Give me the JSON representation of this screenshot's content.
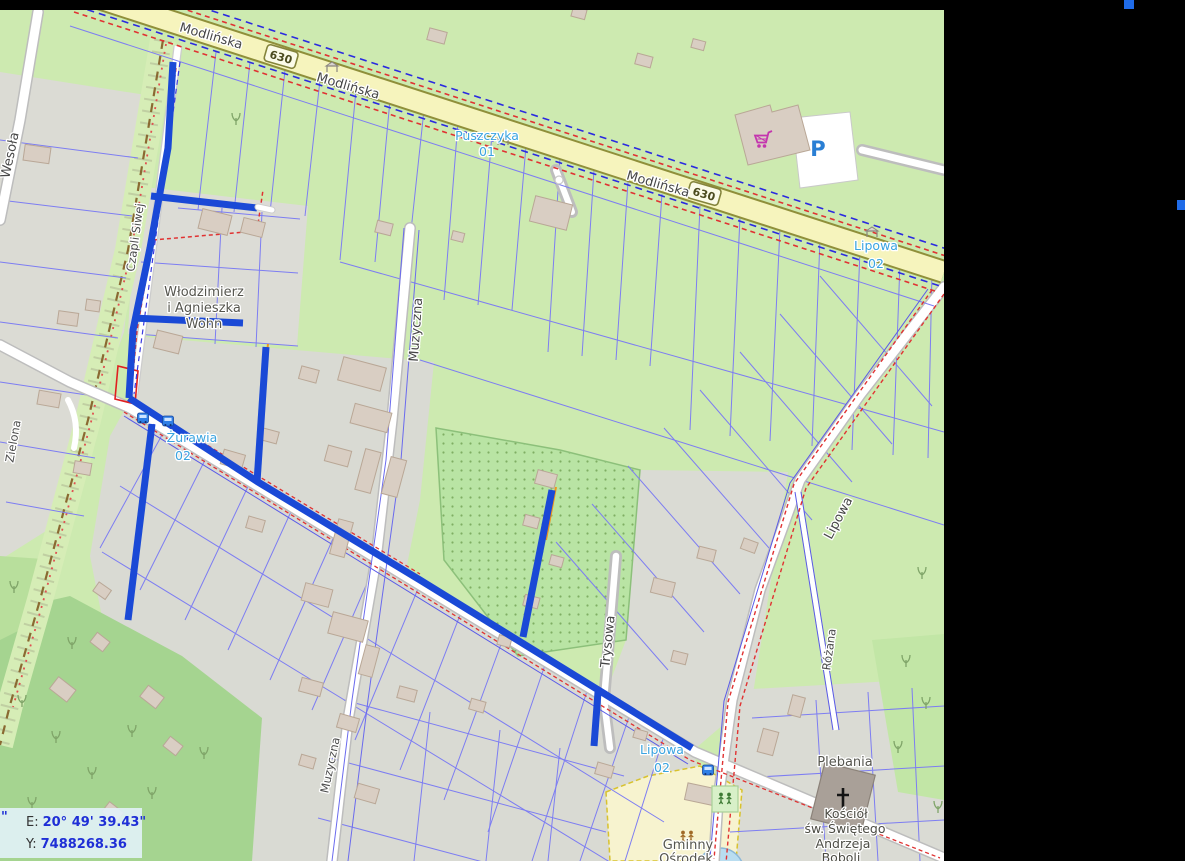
{
  "window": {
    "width": 1185,
    "height": 861,
    "background": "#000000"
  },
  "map": {
    "left": 0,
    "top": 10,
    "width": 944,
    "height": 851
  },
  "colors": {
    "network_blue": "#1a49d6",
    "service_orange": "#f0941e",
    "parcel_line": "#7d7df2",
    "boundary_red": "#e03232",
    "boundary_blue_dashed": "#2a2ae0",
    "road_primary_fill": "#f6f4bd",
    "road_primary_casing": "#8f8f3a",
    "grass": "#cdeab0",
    "residential_gray": "#dbdbd4",
    "orchard": "#b9e4a4",
    "forest": "#a5d490",
    "building": "#d9cec3",
    "stop_label_blue": "#3aa4e0",
    "panel_value_blue": "#1f2fd6",
    "cart_magenta": "#c435ae",
    "parking_blue": "#2a7fd4"
  },
  "street_labels": [
    {
      "text": "Modlińska"
    },
    {
      "text": "Modlińska"
    },
    {
      "text": "Modlińska"
    },
    {
      "text": "Wesoła"
    },
    {
      "text": "Zielona"
    },
    {
      "text": "Czapli Siwej"
    },
    {
      "text": "Muzyczna"
    },
    {
      "text": "Muzyczna"
    },
    {
      "text": "Trysowa"
    },
    {
      "text": "Lipowa"
    },
    {
      "text": "Różana"
    }
  ],
  "shields": [
    {
      "text": "630"
    },
    {
      "text": "630"
    }
  ],
  "stops": [
    {
      "name": "Puszczyka",
      "number": "01"
    },
    {
      "name": "Lipowa",
      "number": "02"
    },
    {
      "name": "Żurawia",
      "number": "02"
    },
    {
      "name": "Lipowa",
      "number": "02"
    }
  ],
  "pois": [
    {
      "lines": [
        "Włodzimierz",
        "i Agnieszka",
        "Wohn"
      ]
    },
    {
      "lines": [
        "Plebania"
      ]
    },
    {
      "lines": [
        "Kościół",
        "św. Świętego",
        "Andrzeja",
        "Boboli"
      ]
    },
    {
      "lines": [
        "Gminny",
        "Ośrodek"
      ]
    }
  ],
  "parking": {
    "label": "P"
  },
  "coordinate_panel": {
    "stray_quote": "\"",
    "e_label": "E:",
    "e_value": "20° 49' 39.43\"",
    "y_label": "Y:",
    "y_value": "7488268.36"
  },
  "icons": {
    "shopping_cart_icon": "magenta shopping cart glyph",
    "parking_icon": "blue letter P on white lot",
    "bus_stop_icon": "blue bus square",
    "shelter_icon": "gray bus shelter",
    "church_cross_icon": "black latin cross",
    "playground_icon": "two figures",
    "tree_icon": "deciduous tree sprig"
  }
}
